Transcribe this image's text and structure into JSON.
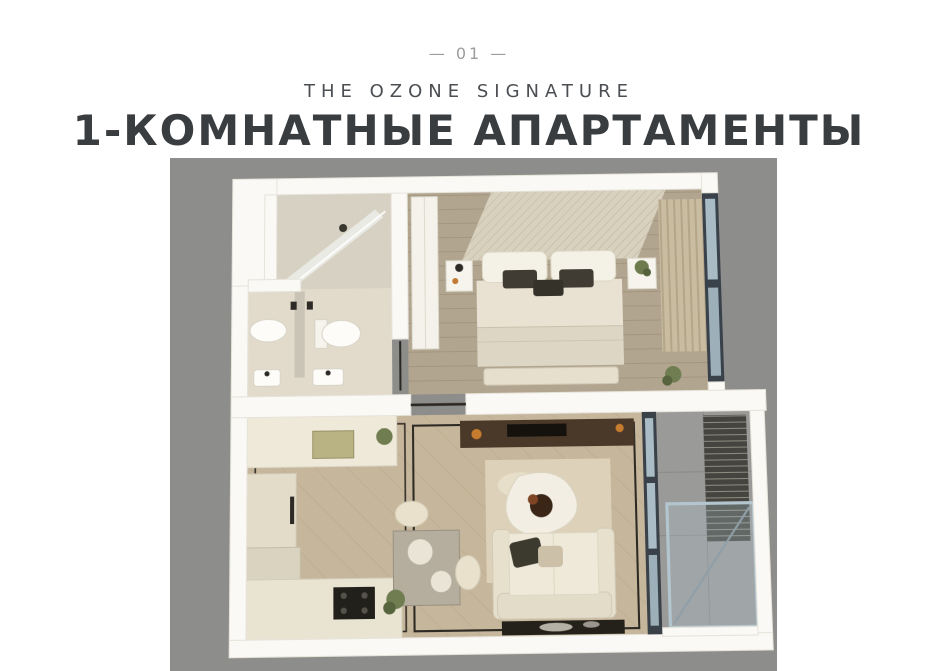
{
  "header": {
    "page_number": "— 01 —",
    "subtitle": "THE OZONE SIGNATURE",
    "title": "1-КОМНАТНЫЕ АПАРТАМЕНТЫ"
  },
  "colors": {
    "page_background": "#ffffff",
    "backdrop_gray": "#8d8d8b",
    "wall_white": "#faf9f5",
    "title_color": "#3a3d40",
    "subtitle_color": "#4b4e52",
    "page_number_color": "#9c9c9c",
    "wood_floor": "#c6b69c",
    "bedroom_floor": "#b2a58f",
    "glass_blue": "#aabdc7",
    "dark_frame": "#3a4148"
  },
  "floor_plan": {
    "kind": "3d-top-down-render",
    "rooms": [
      "bathroom",
      "bedroom",
      "kitchen",
      "living-room",
      "balcony"
    ]
  }
}
